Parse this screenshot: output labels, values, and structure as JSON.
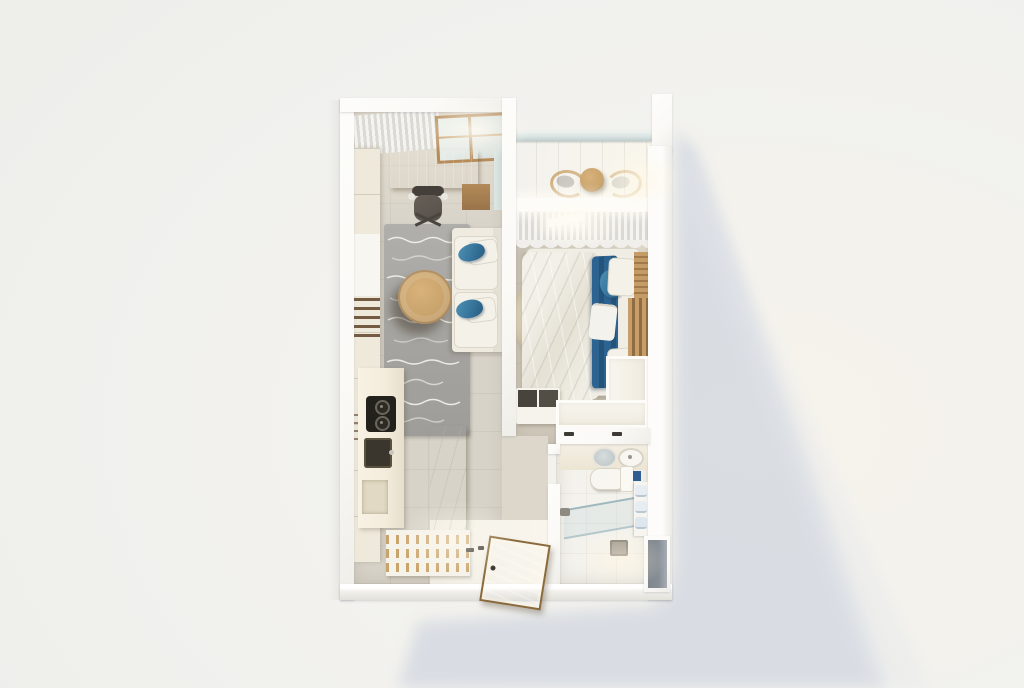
{
  "scene": {
    "type": "3d-floor-plan-render",
    "view": "top-down",
    "unit": "one-bedroom apartment"
  },
  "rooms": {
    "office": "Home office",
    "living": "Living area",
    "kitchen": "Kitchen",
    "entry": "Entryway",
    "balcony": "Balcony",
    "bedroom": "Bedroom",
    "bathroom": "Bathroom",
    "hallway": "Hallway"
  },
  "furniture": {
    "desk": "Desk",
    "officeChair": "Office chair",
    "wardrobe": "Wardrobe",
    "rug": "Area rug",
    "coffeeTable": "Coffee table",
    "sofa": "Sofa",
    "counter": "Kitchen counter",
    "cooktop": "Cooktop",
    "sink": "Kitchen sink",
    "island": "Kitchen island",
    "stools": "Bar stools",
    "shoeRack": "Shoe rack",
    "doorMat": "Entry door",
    "balconyChairs": "Balcony chairs",
    "balconyTable": "Balcony table",
    "railing": "Glass railing",
    "bed": "Double bed",
    "headboard": "Headboard",
    "roundRug": "Round rug",
    "dresser": "Dresser",
    "closet": "Closet",
    "vanity": "Bathroom vanity",
    "toilet": "Toilet",
    "showerGlass": "Shower glass panel",
    "drain": "Shower drain",
    "towelShelf": "Towel shelf",
    "window": "Window",
    "curtains": "Curtains"
  },
  "colors": {
    "bg": "#f1f1ee",
    "bgWarm": "#f6f3ec",
    "shadow": "#d7dbe2",
    "wall": "#fbfaf7",
    "floorLiving": "#d8d3c9",
    "floorLivingLit": "#e8e1d2",
    "floorBedroom": "#cfc8ba",
    "floorBalcony": "#e8dfc8",
    "floorBath": "#e7deca",
    "floorShower": "#f3e9d1",
    "hallway": "#ddd7cb",
    "entryFloor": "#f5f2ea",
    "rug": "#a7a6a2",
    "rugLine": "#ecebe5",
    "rugRound": "#d9ceb4",
    "wood": "#c9a36c",
    "woodDark": "#a27a4a",
    "matWood": "#d4a65c",
    "sofa": "#efebe1",
    "cushion": "#f4f1e9",
    "pillowBlue": "#3b7aa1",
    "pillowBlueDark": "#2a5f85",
    "duvet": "#f0ede4",
    "bedBlue": "#2d6390",
    "bedBlueDark": "#25547b",
    "counter": "#f3ecdc",
    "island": "#f7f4ec",
    "cooktop": "#23211c",
    "sinkDark": "#3a352d",
    "stoolWood": "#bb8751",
    "seatDark": "#4d463e",
    "glass": "#d7e2e0",
    "glassLine": "#9fb8bd",
    "curtain": "#f5f4f1",
    "curtainShade": "#dbd9d3",
    "chairGray": "#bdbcb8",
    "chairDark": "#57514a",
    "notch": "#868d95",
    "mirror": "#b9c2c4",
    "towel": "#e7edf2",
    "thresh": "#3e3a34"
  }
}
